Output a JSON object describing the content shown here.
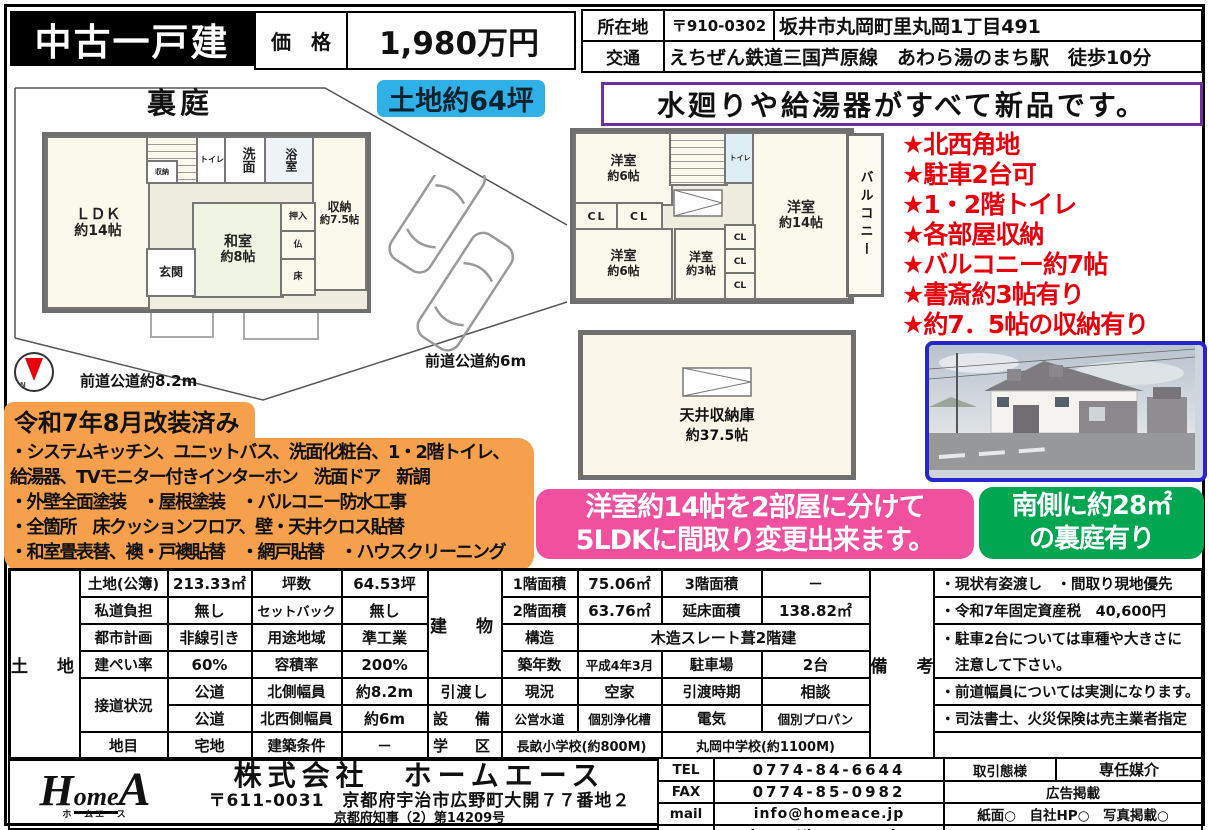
{
  "header": {
    "property_type": "中古一戸建",
    "price_label": "価　格",
    "price_value": "1,980万円",
    "location_label": "所在地",
    "postal_code": "〒910-0302",
    "address": "坂井市丸岡町里丸岡1丁目491",
    "access_label": "交通",
    "access": "えちぜん鉄道三国芦原線　あわら湯のまち駅　徒歩10分"
  },
  "badges": {
    "land_size": "土地約64坪",
    "new_equipment": "水廻りや給湯器がすべて新品です。",
    "layout_line1": "洋室約14帖を2部屋に分けて",
    "layout_line2": "5LDKに間取り変更出来ます。",
    "garden_line1": "南側に約28㎡",
    "garden_line2": "の裏庭有り"
  },
  "floor1": {
    "garden": "裏庭",
    "ldk": "ＬＤＫ",
    "ldk_size": "約14帖",
    "storage": "収納",
    "toilet": "トイレ",
    "washroom": "洗面",
    "bath": "浴室",
    "storage2": "収納",
    "storage2_size": "約7.5帖",
    "japanese_room": "和室",
    "japanese_room_size": "約8帖",
    "entrance": "玄関",
    "closet": "押入",
    "altar": "仏",
    "alcove": "床",
    "road_west": "前道公道約8.2m",
    "road_east": "前道公道約6m"
  },
  "floor2": {
    "room_a": "洋室",
    "room_a_size": "約6帖",
    "toilet": "トイレ",
    "room_b": "洋室",
    "room_b_size": "約14帖",
    "balcony": "バルコニー",
    "cl": "CL",
    "room_c": "洋室",
    "room_c_size": "約6帖",
    "room_d": "洋室",
    "room_d_size": "約3帖"
  },
  "attic": {
    "name": "天井収納庫",
    "size": "約37.5帖"
  },
  "features": [
    "★北西角地",
    "★駐車2台可",
    "★1・2階トイレ",
    "★各部屋収納",
    "★バルコニー約7帖",
    "★書斎約3帖有り",
    "★約7．5帖の収納有り"
  ],
  "renovation": {
    "title": "令和7年8月改装済み",
    "lines": [
      "・システムキッチン、ユニットバス、洗面化粧台、1・2階トイレ、",
      "給湯器、TVモニター付きインターホン　洗面ドア　新調",
      "・外壁全面塗装　・屋根塗装　・バルコニー防水工事",
      "・全箇所　床クッションフロア、壁・天井クロス貼替",
      "・和室畳表替、襖・戸襖貼替　・網戸貼替　・ハウスクリーニング"
    ]
  },
  "table": {
    "land_header": "土　地",
    "building_header": "建　物",
    "handover_header": "引渡し",
    "equipment_header": "設　備",
    "school_header": "学　区",
    "remarks_header": "備　考",
    "land": [
      [
        "土地(公簿)",
        "213.33㎡",
        "坪数",
        "64.53坪"
      ],
      [
        "私道負担",
        "無し",
        "セットバック",
        "無し"
      ],
      [
        "都市計画",
        "非線引き",
        "用途地域",
        "準工業"
      ],
      [
        "建ぺい率",
        "60%",
        "容積率",
        "200%"
      ],
      [
        "接道状況",
        "公道",
        "北側幅員",
        "約8.2m"
      ],
      [
        "公道",
        "北西側幅員",
        "約6m"
      ],
      [
        "地目",
        "宅地",
        "建築条件",
        "－"
      ]
    ],
    "building": [
      [
        "1階面積",
        "75.06㎡",
        "3階面積",
        "－"
      ],
      [
        "2階面積",
        "63.76㎡",
        "延床面積",
        "138.82㎡"
      ],
      [
        "構造",
        "木造スレート葺2階建"
      ],
      [
        "築年数",
        "平成4年3月",
        "駐車場",
        "2台"
      ]
    ],
    "handover": [
      "現況",
      "空家",
      "引渡時期",
      "相談"
    ],
    "equipment": [
      "公営水道",
      "個別浄化槽",
      "電気",
      "個別プロパン"
    ],
    "school": [
      "長畝小学校(約800M)",
      "丸岡中学校(約1100M)"
    ],
    "remarks": [
      "・現状有姿渡し　・間取り現地優先",
      "・令和7年固定資産税　40,600円",
      "・駐車2台については車種や大きさに",
      "　注意して下さい。",
      "・前道幅員については実測になります。",
      "・司法書士、火災保険は売主業者指定",
      ""
    ]
  },
  "company": {
    "logo_h": "H",
    "logo_ome": "ome",
    "logo_a": "A",
    "logo_sub": "ホームエース",
    "name": "株式会社　ホームエース",
    "postal_address": "〒611-0031　京都府宇治市広野町大開７７番地２",
    "license": "京都府知事（2）第14209号"
  },
  "contact": {
    "tel_label": "TEL",
    "tel_value": "0774-84-6644",
    "fax_label": "FAX",
    "fax_value": "0774-85-0982",
    "mail_label": "mail",
    "mail_value": "info@homeace.jp",
    "url_label": "URL",
    "url_value": "http://homeace.jp",
    "transaction_label": "取引態様",
    "transaction_value": "専任媒介",
    "ad_header": "広告掲載",
    "ad_media": "紙面○　自社HP○　写真掲載○",
    "ad_note": "インターネット掲載はすべて不可"
  },
  "colors": {
    "title_bar_bg": "#000000",
    "land_badge": "#2FB1E8",
    "new_banner_border": "#7030A0",
    "features_red": "#E8000D",
    "renovation_orange": "#F6A04E",
    "layout_pink": "#F0509E",
    "garden_green": "#00A650",
    "photo_border": "#2626CC"
  }
}
